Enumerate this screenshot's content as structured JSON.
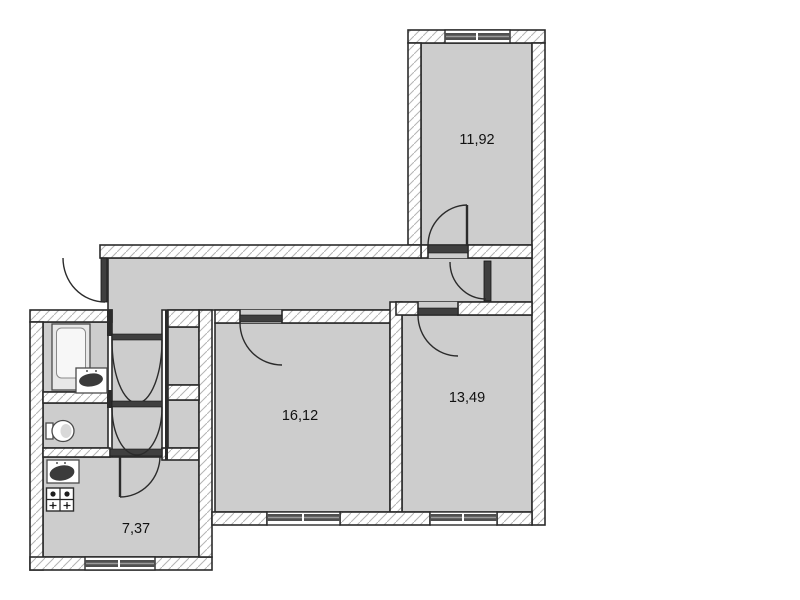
{
  "plan": {
    "type": "apartment-floor-plan",
    "rooms": [
      {
        "id": "room-top",
        "area_label": "11,92"
      },
      {
        "id": "room-center",
        "area_label": "16,12"
      },
      {
        "id": "room-right",
        "area_label": "13,49"
      },
      {
        "id": "kitchen",
        "area_label": "7,37"
      }
    ],
    "unlabeled_spaces": [
      "corridor",
      "inner-hallway",
      "bathroom",
      "toilet",
      "built-in-closet-upper",
      "built-in-closet-lower",
      "corridor-storage"
    ],
    "fixtures": [
      "bathtub-icon",
      "wash-basin-icon",
      "toilet-icon",
      "kitchen-sink-icon",
      "stove-icon"
    ],
    "door_count": 8,
    "window_count": 4
  },
  "colors": {
    "background": "#ffffff",
    "floor": "#cdcdcd",
    "hatch": "#b4b4b4",
    "outline": "#2b2b2b",
    "window": "#4f4f4f",
    "door": "#3f3f3f",
    "label": "#111111"
  }
}
